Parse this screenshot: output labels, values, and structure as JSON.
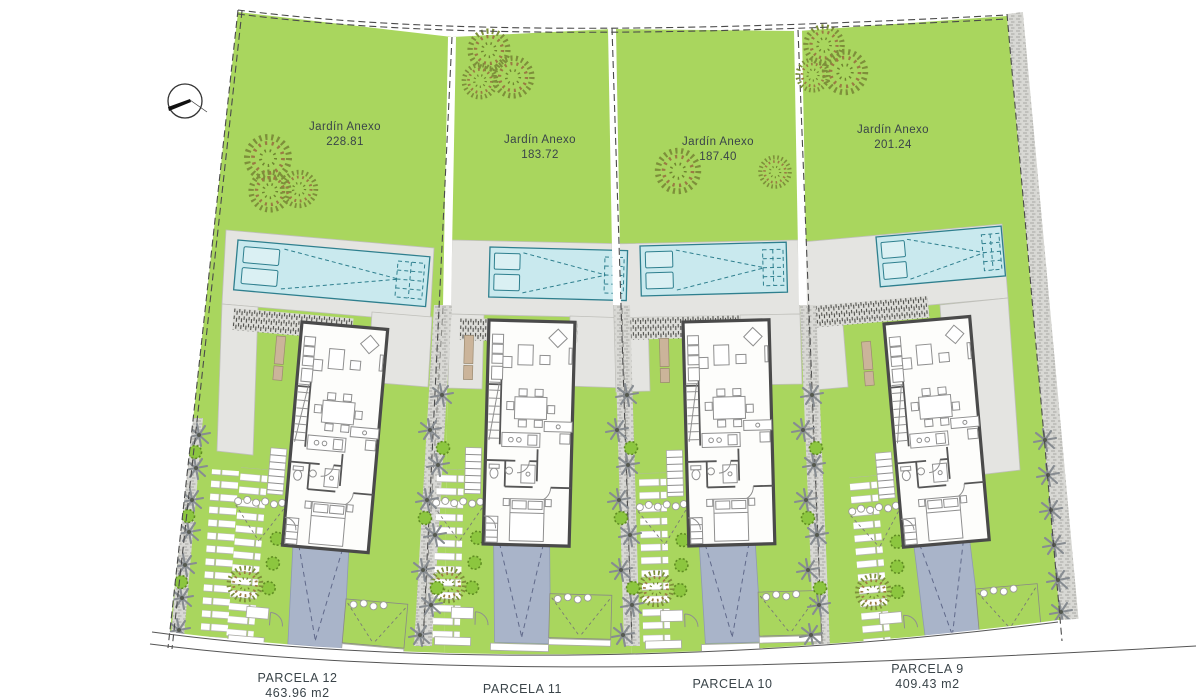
{
  "drawing": {
    "type": "residential-site-plan",
    "north_arrow": "compass-needle",
    "gardens": [
      {
        "label": "Jardín Anexo",
        "area": "228.81"
      },
      {
        "label": "Jardín Anexo",
        "area": "183.72"
      },
      {
        "label": "Jardín Anexo",
        "area": "187.40"
      },
      {
        "label": "Jardín Anexo",
        "area": "201.24"
      }
    ],
    "parcels": [
      {
        "label": "PARCELA 12",
        "area": "463.96 m2"
      },
      {
        "label": "PARCELA 11",
        "area": null
      },
      {
        "label": "PARCELA 10",
        "area": null
      },
      {
        "label": "PARCELA 9",
        "area": "409.43 m2"
      }
    ],
    "colors": {
      "lawn": "#a9d65e",
      "pool": "#c9e9ee",
      "pool_edge": "#2e7f8e",
      "terrace": "#e4e4e1",
      "driveway": "#a9b4c9",
      "wall": "#4a4a4a",
      "road": "#d8d8d4",
      "label": "#3a4449",
      "palm": "#878c91",
      "bush": "#8cc63f",
      "bush_edge": "#5f8c22",
      "tree_ring": "#7d8f3a",
      "tree_ring2": "#9a7b43"
    }
  }
}
